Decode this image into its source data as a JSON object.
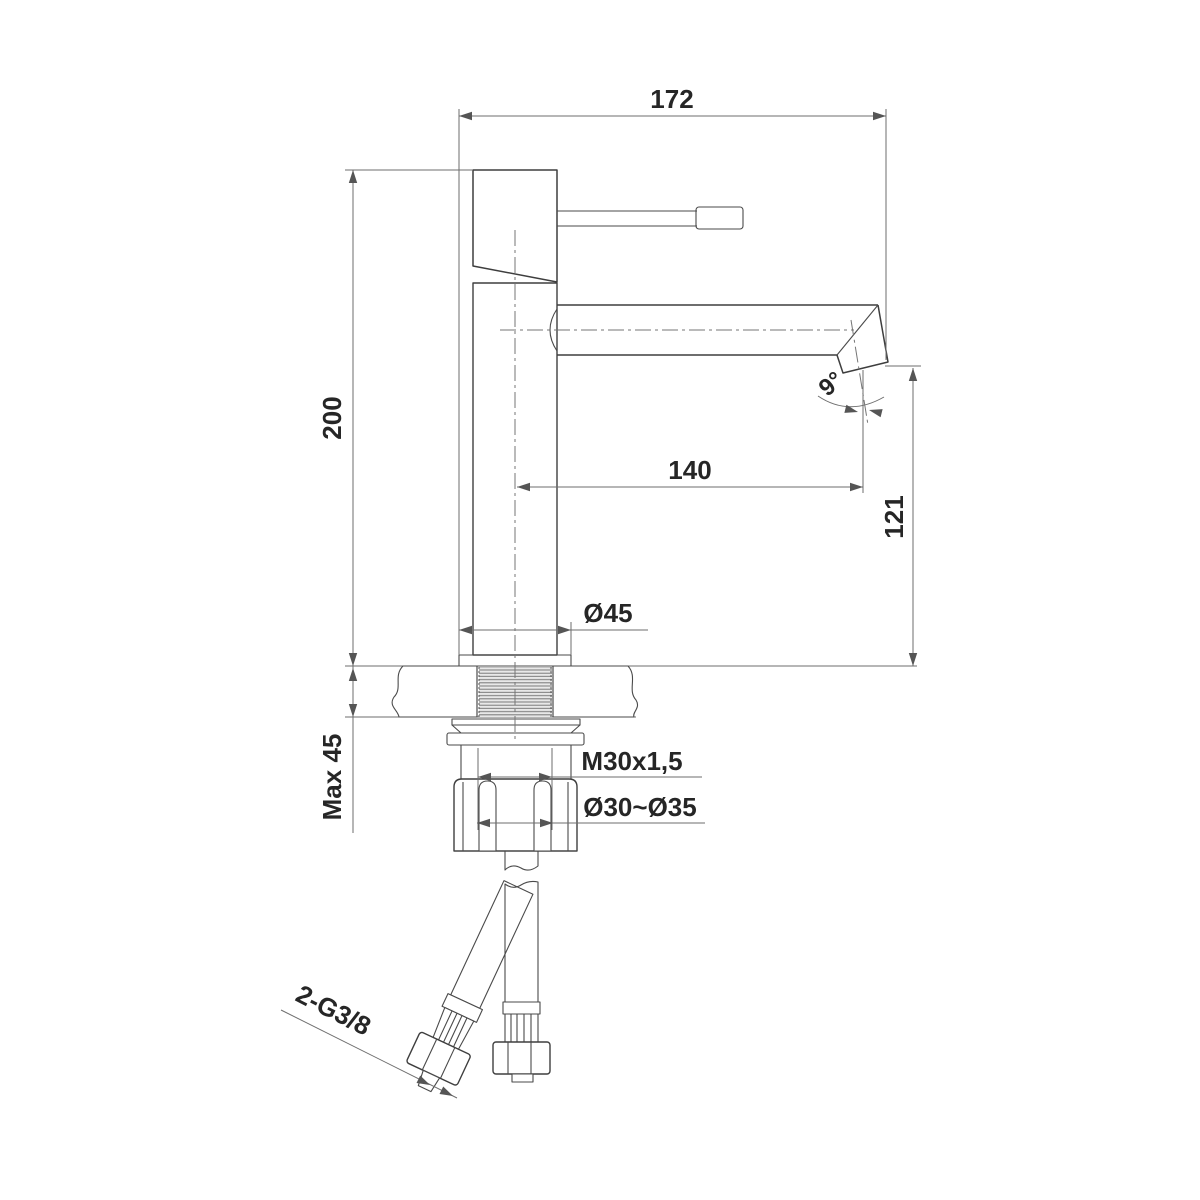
{
  "colors": {
    "background": "#ffffff",
    "object_line": "#3e3e3e",
    "dimension_line": "#6e6e6e",
    "text": "#262626"
  },
  "labels": {
    "overall_width": "172",
    "overall_height": "200",
    "spout_reach": "140",
    "spout_outlet_height": "121",
    "base_diameter": "Ø45",
    "max_deck_thickness": "Max 45",
    "shank_thread": "M30x1,5",
    "mounting_hole_diameter": "Ø30~Ø35",
    "supply_hose_thread": "2-G3/8",
    "spout_angle": "9°"
  }
}
